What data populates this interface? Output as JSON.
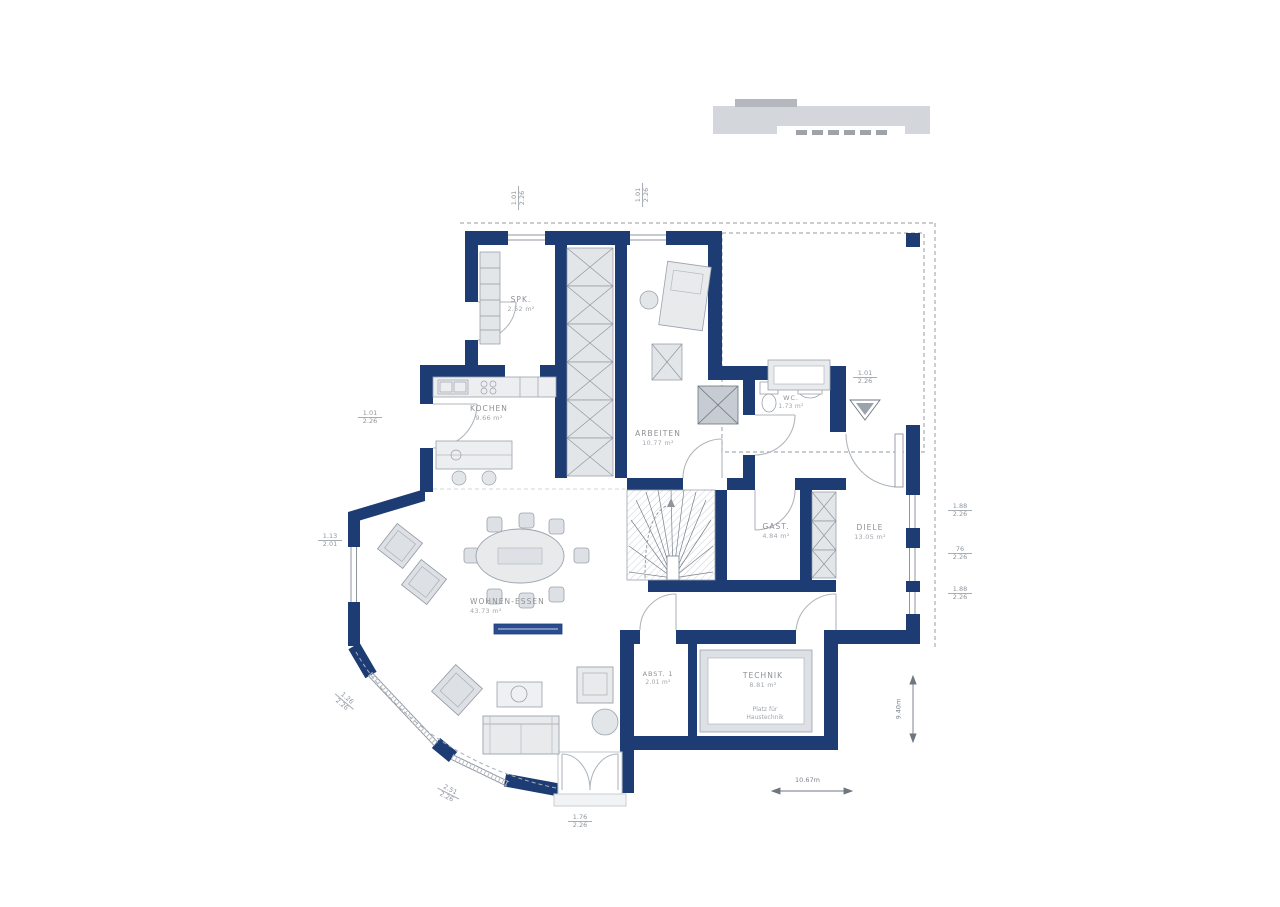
{
  "colors": {
    "wall": "#1d3c74",
    "furniture_fill": "#e8eaec",
    "line_gray": "#9aa2ac",
    "dash_gray": "#a8afb8"
  },
  "rooms": {
    "spk": {
      "name": "SPK.",
      "area": "2.52 m²"
    },
    "kochen": {
      "name": "KOCHEN",
      "area": "9.66 m²"
    },
    "arbeiten": {
      "name": "ARBEITEN",
      "area": "10.77 m²"
    },
    "wc": {
      "name": "WC.",
      "area": "1.73 m²"
    },
    "gast": {
      "name": "GAST.",
      "area": "4.84 m²"
    },
    "diele": {
      "name": "DIELE",
      "area": "13.05 m²"
    },
    "wohnen": {
      "name": "WOHNEN-ESSEN",
      "area": "43.73 m²"
    },
    "abst": {
      "name": "ABST. 1",
      "area": "2.01 m²"
    },
    "technik": {
      "name": "TECHNIK",
      "area": "8.81 m²",
      "note_line1": "Platz für",
      "note_line2": "Haustechnik"
    }
  },
  "dimensions": {
    "total_width": "10.67m",
    "total_height": "9.40m",
    "top_window_left": {
      "w": "1.01",
      "h": "2.26"
    },
    "top_window_right": {
      "w": "1.01",
      "h": "2.26"
    },
    "left_door": {
      "w": "1.01",
      "h": "2.26"
    },
    "left_window": {
      "w": "1.13",
      "h": "2.01"
    },
    "right_window_1": {
      "w": "1.88",
      "h": "2.26"
    },
    "right_window_2": {
      "w": "76",
      "h": "2.26"
    },
    "right_window_3": {
      "w": "1.88",
      "h": "2.26"
    },
    "entry_door": {
      "w": "1.01",
      "h": "2.26"
    },
    "bay_window_1": {
      "w": "1.26",
      "h": "2.26"
    },
    "bay_window_2": {
      "w": "2.51",
      "h": "2.26"
    },
    "front_door": {
      "w": "1.76",
      "h": "2.26"
    }
  }
}
